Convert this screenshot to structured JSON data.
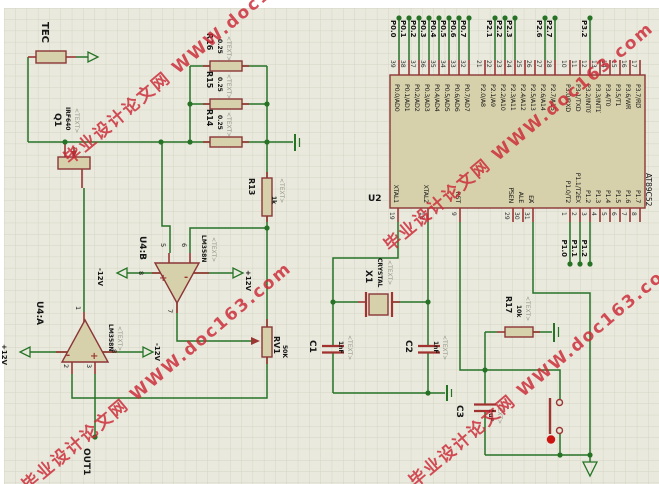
{
  "watermark": {
    "text": "毕业设计论文网 WWW.doc163.com",
    "color": "#cc2936"
  },
  "labels": {
    "placeholder": "<TEXT>",
    "out1": "OUT1",
    "plus": "+",
    "minus": "-"
  },
  "power": {
    "plus12": "+12V",
    "minus12": "-12V"
  },
  "components": {
    "tec": {
      "ref": "TEC"
    },
    "q1": {
      "ref": "Q1",
      "value": "IRF640"
    },
    "r13": {
      "ref": "R13",
      "value": "1k"
    },
    "r14": {
      "ref": "R14",
      "value": "0.25"
    },
    "r15": {
      "ref": "R15",
      "value": "0.25"
    },
    "r16": {
      "ref": "R16",
      "value": "0.25"
    },
    "r17": {
      "ref": "R17",
      "value": "10k"
    },
    "rv1": {
      "ref": "RV1",
      "value": "50K"
    },
    "c1": {
      "ref": "C1",
      "value": "1nF"
    },
    "c2": {
      "ref": "C2",
      "value": "1nF"
    },
    "c3": {
      "ref": "C3",
      "value": "1uF"
    },
    "x1": {
      "ref": "X1",
      "value": "CRYSTAL"
    },
    "u4a": {
      "ref": "U4:A",
      "value": "LM358N",
      "pin_out": "1",
      "pin_inv": "2",
      "pin_noninv": "3",
      "pin_v": "8"
    },
    "u4b": {
      "ref": "U4:B",
      "value": "LM358N",
      "pin_noninv": "5",
      "pin_inv": "6",
      "pin_out": "7",
      "pin_v": "8"
    }
  },
  "mcu": {
    "ref": "U2",
    "part": "AT89C52",
    "top_groups": [
      {
        "x0": 399,
        "dx": 10,
        "pins": [
          {
            "num": "39",
            "label": "P0.0/AD0",
            "net": "P0.0"
          },
          {
            "num": "38",
            "label": "P0.1/AD1",
            "net": "P0.1"
          },
          {
            "num": "37",
            "label": "P0.2/AD2",
            "net": "P0.2"
          },
          {
            "num": "36",
            "label": "P0.3/AD3",
            "net": "P0.3"
          },
          {
            "num": "35",
            "label": "P0.4/AD4",
            "net": "P0.4"
          },
          {
            "num": "34",
            "label": "P0.5/AD5",
            "net": "P0.5"
          },
          {
            "num": "33",
            "label": "P0.6/AD6",
            "net": "P0.6"
          },
          {
            "num": "32",
            "label": "P0.7/AD7",
            "net": "P0.7"
          }
        ]
      },
      {
        "x0": 485,
        "dx": 10,
        "pins": [
          {
            "num": "21",
            "label": "P2.0/A8"
          },
          {
            "num": "22",
            "label": "P2.1/A9",
            "net": "P2.1"
          },
          {
            "num": "23",
            "label": "P2.2/A10",
            "net": "P2.2"
          },
          {
            "num": "24",
            "label": "P2.3/A11",
            "net": "P2.3"
          },
          {
            "num": "25",
            "label": "P2.4/A12"
          },
          {
            "num": "26",
            "label": "P2.5/A13"
          },
          {
            "num": "27",
            "label": "P2.6/A14",
            "net": "P2.6"
          },
          {
            "num": "28",
            "label": "P2.7/A15",
            "net": "P2.7"
          }
        ]
      },
      {
        "x0": 570,
        "dx": 10,
        "pins": [
          {
            "num": "10",
            "label": "P3.0/RXD"
          },
          {
            "num": "11",
            "label": "P3.1/TXD"
          },
          {
            "num": "12",
            "label": "P3.2/",
            "ovl": "INT0",
            "net": "P3.2"
          },
          {
            "num": "13",
            "label": "P3.3/",
            "ovl": "INT1"
          },
          {
            "num": "14",
            "label": "P3.4/T0"
          },
          {
            "num": "15",
            "label": "P3.5/T1"
          },
          {
            "num": "16",
            "label": "P3.6/",
            "ovl": "WR"
          },
          {
            "num": "17",
            "label": "P3.7/",
            "ovl": "RD"
          }
        ]
      }
    ],
    "bottom_pins": [
      {
        "x": 398,
        "num": "19",
        "label": "XTAL1"
      },
      {
        "x": 428,
        "num": "18",
        "label": "XTAL2"
      },
      {
        "x": 460,
        "num": "9",
        "label": "RST"
      },
      {
        "x": 513,
        "num": "29",
        "label": "",
        "ovl": "PSEN"
      },
      {
        "x": 523,
        "num": "30",
        "label": "ALE"
      },
      {
        "x": 533,
        "num": "31",
        "label": "",
        "ovl": "EA"
      },
      {
        "x": 570,
        "num": "1",
        "label": "P1.0/T2",
        "net": "P1.0"
      },
      {
        "x": 580,
        "num": "2",
        "label": "P1.1/T2EX",
        "net": "P1.1"
      },
      {
        "x": 590,
        "num": "3",
        "label": "P1.2",
        "net": "P1.2"
      },
      {
        "x": 600,
        "num": "4",
        "label": "P1.3"
      },
      {
        "x": 610,
        "num": "5",
        "label": "P1.4"
      },
      {
        "x": 620,
        "num": "6",
        "label": "P1.5"
      },
      {
        "x": 630,
        "num": "7",
        "label": "P1.6"
      },
      {
        "x": 640,
        "num": "8",
        "label": "P1.7"
      }
    ]
  }
}
